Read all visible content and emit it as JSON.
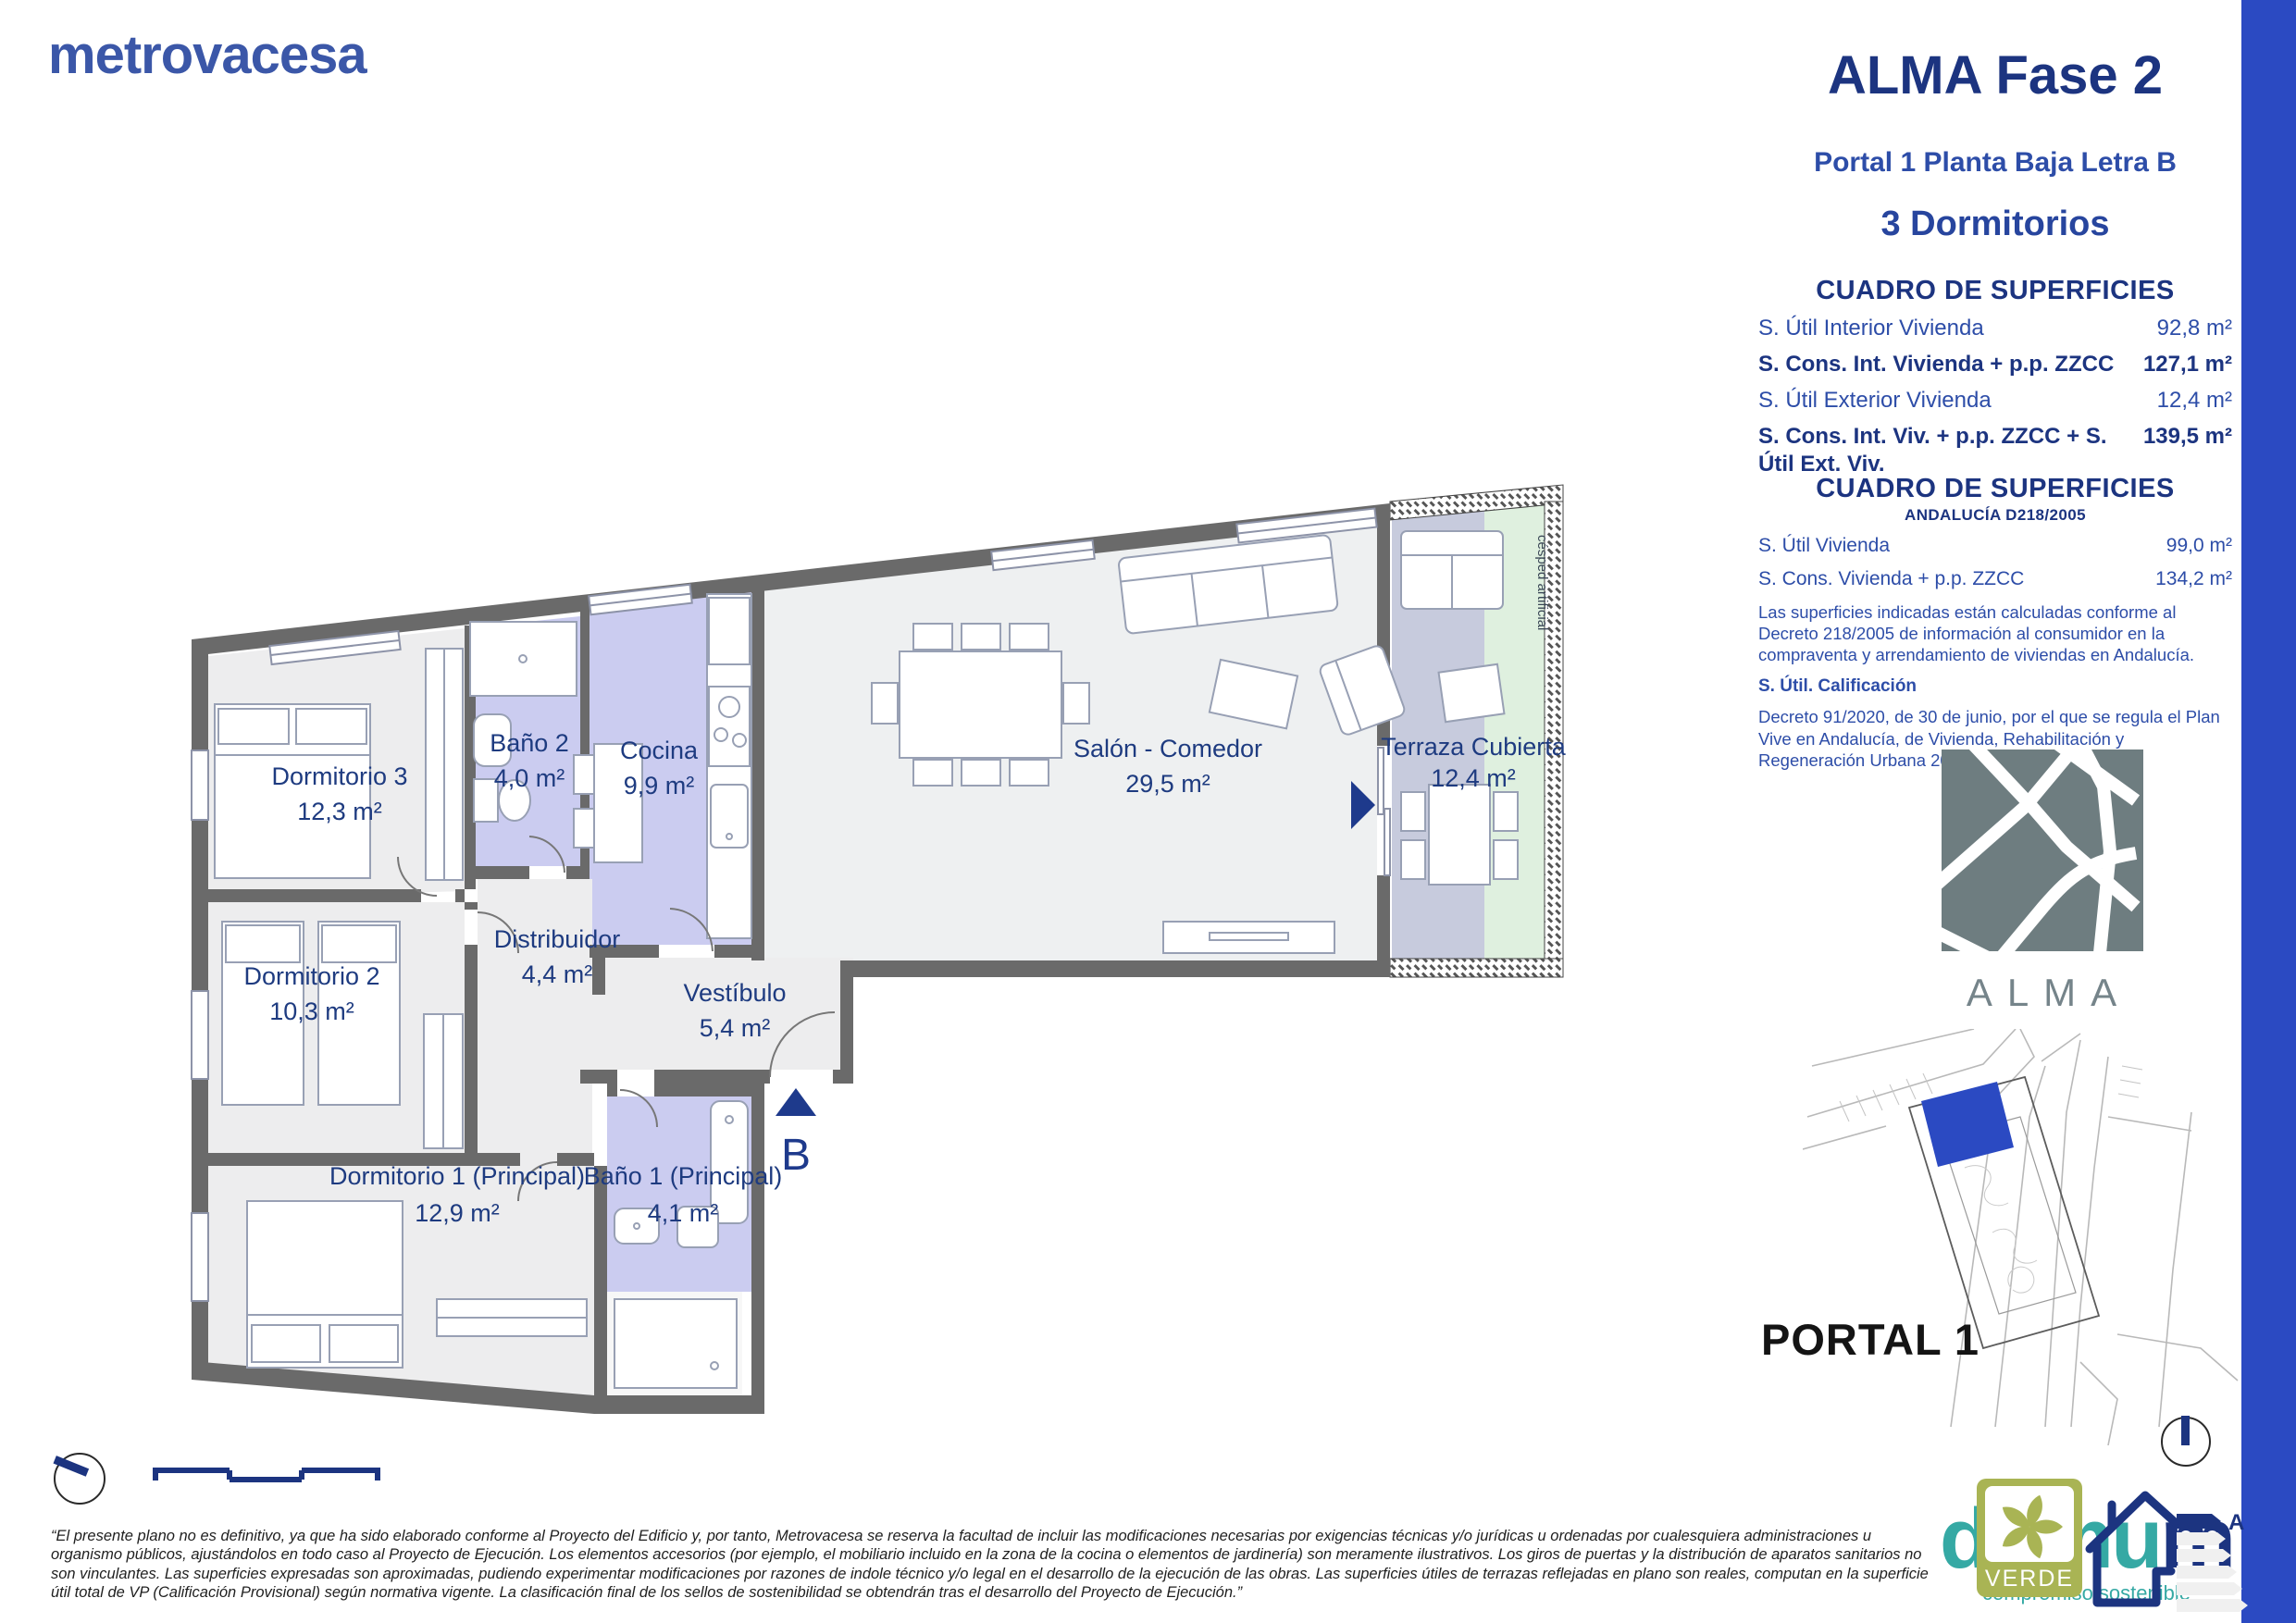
{
  "brand": {
    "logo_text": "metrovacesa"
  },
  "header": {
    "project": "ALMA Fase 2",
    "unit": "Portal 1 Planta Baja Letra B",
    "bedrooms": "3 Dormitorios"
  },
  "tables": {
    "main": {
      "title": "CUADRO DE SUPERFICIES",
      "rows": [
        {
          "label": "S. Útil Interior Vivienda",
          "value": "92,8 m²",
          "bold": false
        },
        {
          "label": "S. Cons. Int. Vivienda + p.p. ZZCC",
          "value": "127,1 m²",
          "bold": true
        },
        {
          "label": "S. Útil Exterior Vivienda",
          "value": "12,4 m²",
          "bold": false
        },
        {
          "label": "S. Cons. Int. Viv. + p.p. ZZCC + S. Útil Ext. Viv.",
          "value": "139,5 m²",
          "bold": true
        }
      ]
    },
    "andalucia": {
      "title": "CUADRO DE SUPERFICIES",
      "subtitle": "ANDALUCÍA D218/2005",
      "rows": [
        {
          "label": "S. Útil Vivienda",
          "value": "99,0 m²"
        },
        {
          "label": "S. Cons. Vivienda + p.p. ZZCC",
          "value": "134,2 m²"
        }
      ],
      "note_218": "Las superficies indicadas están calculadas conforme al Decreto 218/2005 de información al consumidor en la compraventa y arrendamiento de viviendas en Andalucía.",
      "calificacion_label": "S. Útil. Calificación",
      "note_91": "Decreto 91/2020, de 30 de junio, por el que se regula el Plan Vive en Andalucía, de Vivienda, Rehabilitación y Regeneración Urbana 2020-2030."
    }
  },
  "floor_plan": {
    "rooms": [
      {
        "name": "Dormitorio 3",
        "area": "12,3 m²"
      },
      {
        "name": "Baño 2",
        "area": "4,0 m²"
      },
      {
        "name": "Cocina",
        "area": "9,9 m²"
      },
      {
        "name": "Distribuidor",
        "area": "4,4 m²"
      },
      {
        "name": "Dormitorio 2",
        "area": "10,3 m²"
      },
      {
        "name": "Vestíbulo",
        "area": "5,4 m²"
      },
      {
        "name": "Dormitorio 1 (Principal)",
        "area": "12,9 m²"
      },
      {
        "name": "Baño 1 (Principal)",
        "area": "4,1 m²"
      },
      {
        "name": "Salón - Comedor",
        "area": "29,5 m²"
      },
      {
        "name": "Terraza Cubierta",
        "area": "12,4 m²"
      }
    ],
    "entrance_label": "B",
    "cesped_label": "césped artificial"
  },
  "site_plan": {
    "portal_label": "PORTAL 1"
  },
  "logos": {
    "alma": "ALMA",
    "verde": "VERDE",
    "energy_rating": "A",
    "domum_part1": "domu",
    "domum_part2": "m",
    "domum_tagline": "compromiso sostenible"
  },
  "disclaimer": "“El presente plano no es definitivo, ya que ha sido elaborado conforme al Proyecto del Edificio y, por tanto, Metrovacesa se reserva la facultad de incluir las modificaciones necesarias por exigencias técnicas y/o jurídicas u ordenadas por cualesquiera administraciones u organismo públicos, ajustándolos en todo caso al Proyecto de Ejecución. Los elementos accesorios (por ejemplo, el mobiliario incluido en la zona de la cocina o elementos de jardinería) son meramente ilustrativos. Los giros de puertas y la distribución de aparatos sanitarios no son vinculantes. Las superficies expresadas son aproximadas, pudiendo experimentar modificaciones por razones de indole técnico y/o legal en el desarrollo de la ejecución de las obras. Las superficies útiles de terrazas reflejadas en plano son reales, computan en la superficie útil total de VP (Calificación Provisional) según normativa vigente. La clasificación final de los sellos de sostenibilidad se obtendrán tras el desarrollo del Proyecto de Ejecución.”",
  "colors": {
    "navy": "#1c3480",
    "text_blue": "#2d4da8",
    "metrovacesa_blue": "#3b57a8",
    "accent_bar_blue": "#2b4ac2",
    "wall_gray": "#6a6a6a",
    "wet_room_lavender": "#cbccf0",
    "floor_gray": "#ededee",
    "terrace_gray": "#c7cbdd",
    "terrace_green": "#dff0df",
    "alma_slate": "#6e7d80",
    "verde_olive": "#a9b454",
    "domum_teal": "#35a9a4"
  }
}
